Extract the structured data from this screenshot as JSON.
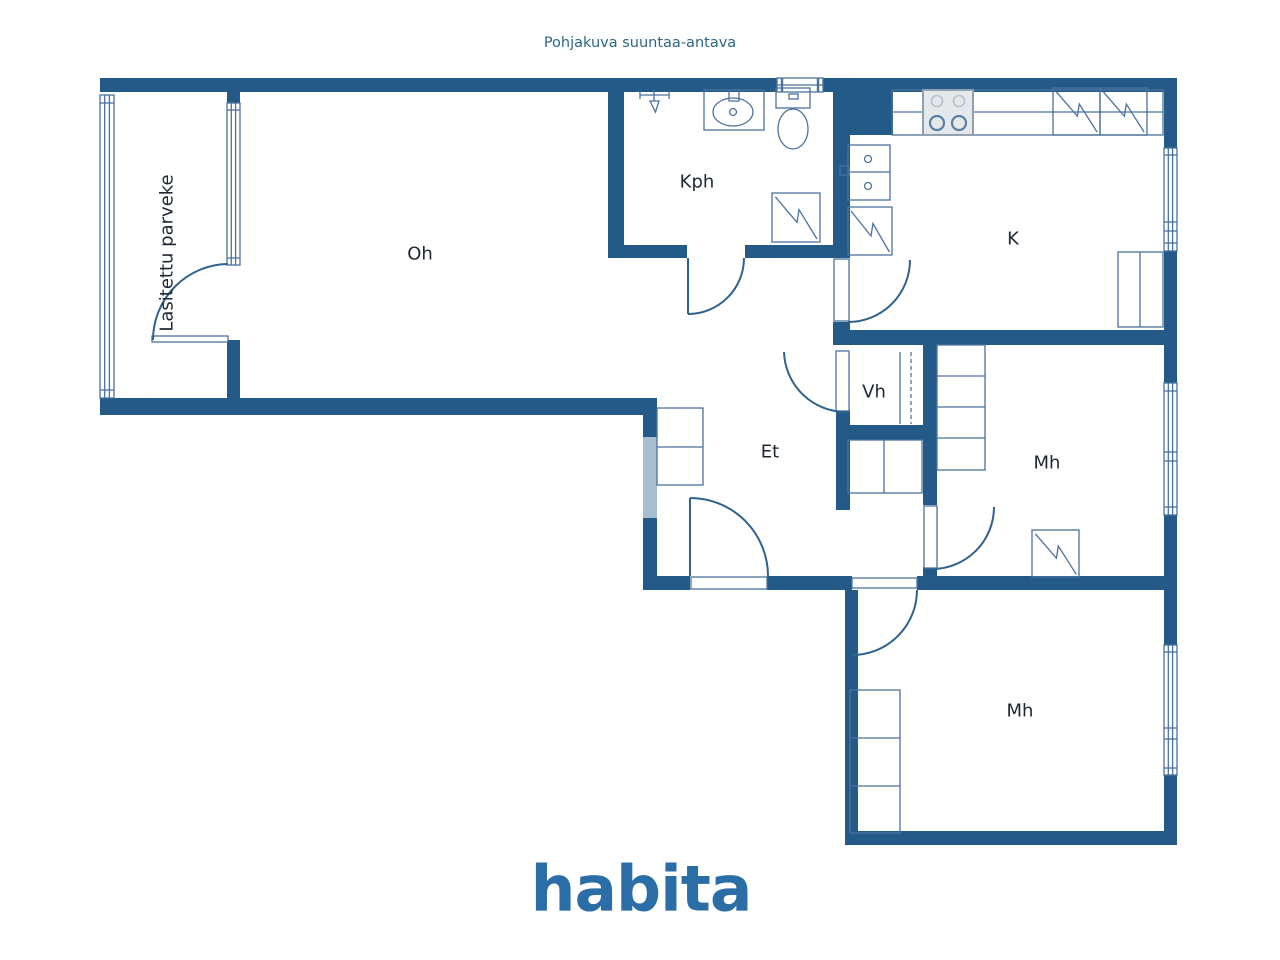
{
  "header": {
    "title": "Pohjakuva suuntaa-antava"
  },
  "rooms": {
    "balcony": {
      "label": "Lasitettu parveke"
    },
    "living": {
      "label": "Oh"
    },
    "bathroom": {
      "label": "Kph"
    },
    "kitchen": {
      "label": "K"
    },
    "closet": {
      "label": "Vh"
    },
    "entry": {
      "label": "Et"
    },
    "bedroom1": {
      "label": "Mh"
    },
    "bedroom2": {
      "label": "Mh"
    }
  },
  "footer": {
    "logo_text": "habita"
  },
  "fixture_icons": [
    "shower-icon",
    "sink-icon",
    "toilet-icon",
    "water-heater-icon",
    "stove-icon",
    "fridge-icon",
    "freezer-icon",
    "kitchen-sink-icon",
    "dishwasher-icon",
    "wardrobe-icon",
    "window-icon",
    "door-icon",
    "sliding-door-icon"
  ],
  "colors": {
    "wall": "#235a87",
    "wall-light": "#a9bdd1",
    "line": "#4b729d",
    "arc": "#2e628f",
    "label": "#1d2733",
    "title": "#2d6585",
    "logo": "#2b6da6",
    "stove-fill": "#e4e8eb",
    "stove-line": "#8fa0b0"
  }
}
